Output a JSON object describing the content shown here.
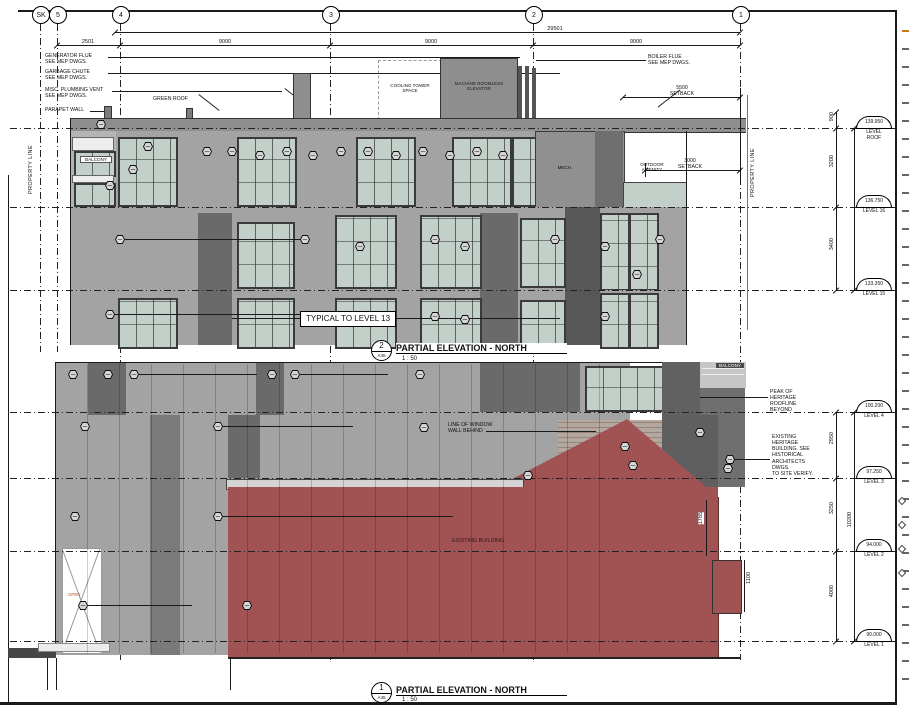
{
  "palette": {
    "red": "#a15252",
    "glass": "#c3d0c9",
    "wall": "#a3a3a3",
    "wall_light": "#b4b4b4",
    "wall_dark": "#6a6a6a",
    "wall_mid": "#8e8e8e",
    "brick": "#b3a79e",
    "line": "#1a1a1a"
  },
  "grid": {
    "bubbles": [
      "SK",
      "5",
      "4",
      "3",
      "2",
      "1"
    ]
  },
  "top": {
    "dims": {
      "overall": "29501",
      "seg": [
        "2501",
        "9000",
        "9000",
        "9000"
      ],
      "vert": [
        "900",
        "3200",
        "3400"
      ]
    },
    "setback1": {
      "value": "5500",
      "label": "SETBACK"
    },
    "setback2": {
      "value": "3000",
      "label": "SETBACK"
    },
    "ann": [
      "GENERATOR FLUE\nSEE MEP DWGS.",
      "GARBAGE CHUTE\nSEE MEP DWGS.",
      "MISC. PLUMBING VENT\nSEE MEP DWGS.",
      "PARAPET WALL"
    ],
    "labels": {
      "green_roof": "GREEN ROOF",
      "balcony": "BALCONY",
      "cooling": "COOLING TOWER\nSPACE",
      "machine": "MACHINE ROOMLESS\nELEVATOR",
      "boiler": "BOILER FLUE\nSEE MEP DWGS.",
      "mech": "MECH.",
      "amenity": "OUTDOOR\nAMENITY",
      "property_line": "PROPERTY LINE",
      "typical": "TYPICAL TO LEVEL 13"
    },
    "levels": [
      {
        "elev": "139.950",
        "name": "LEVEL\nROOF"
      },
      {
        "elev": "136.750",
        "name": "LEVEL 16"
      },
      {
        "elev": "133.350",
        "name": "LEVEL 15"
      }
    ],
    "title": {
      "num": "2",
      "sheet": "A45",
      "text": "PARTIAL ELEVATION - NORTH",
      "scale": "1 : 50"
    }
  },
  "bottom": {
    "dims": {
      "vert": [
        "2950",
        "3250",
        "4000"
      ],
      "overall": "10200",
      "d1": "1785",
      "d2": "1100"
    },
    "ann": [
      "PEAK OF\nHERITAGE\nROOFLINE\nBEYOND",
      "EXISTING HERITAGE\nBUILDING. SEE\nHISTORICAL\nARCHITECTS DWGS.\nTO SITE VERIFY."
    ],
    "labels": {
      "balcony": "BALCONY",
      "window_wall": "LINE OF WINDOW\nWALL BEHIND",
      "existing": "EXISTING BUILDING",
      "open": "OPEN"
    },
    "levels": [
      {
        "elev": "100.200",
        "name": "LEVEL 4"
      },
      {
        "elev": "97.250",
        "name": "LEVEL 3"
      },
      {
        "elev": "94.000",
        "name": "LEVEL 2"
      },
      {
        "elev": "90.000",
        "name": "LEVEL 1"
      }
    ],
    "title": {
      "num": "1",
      "sheet": "A45",
      "text": "PARTIAL ELEVATION - NORTH",
      "scale": "1 : 50"
    }
  }
}
